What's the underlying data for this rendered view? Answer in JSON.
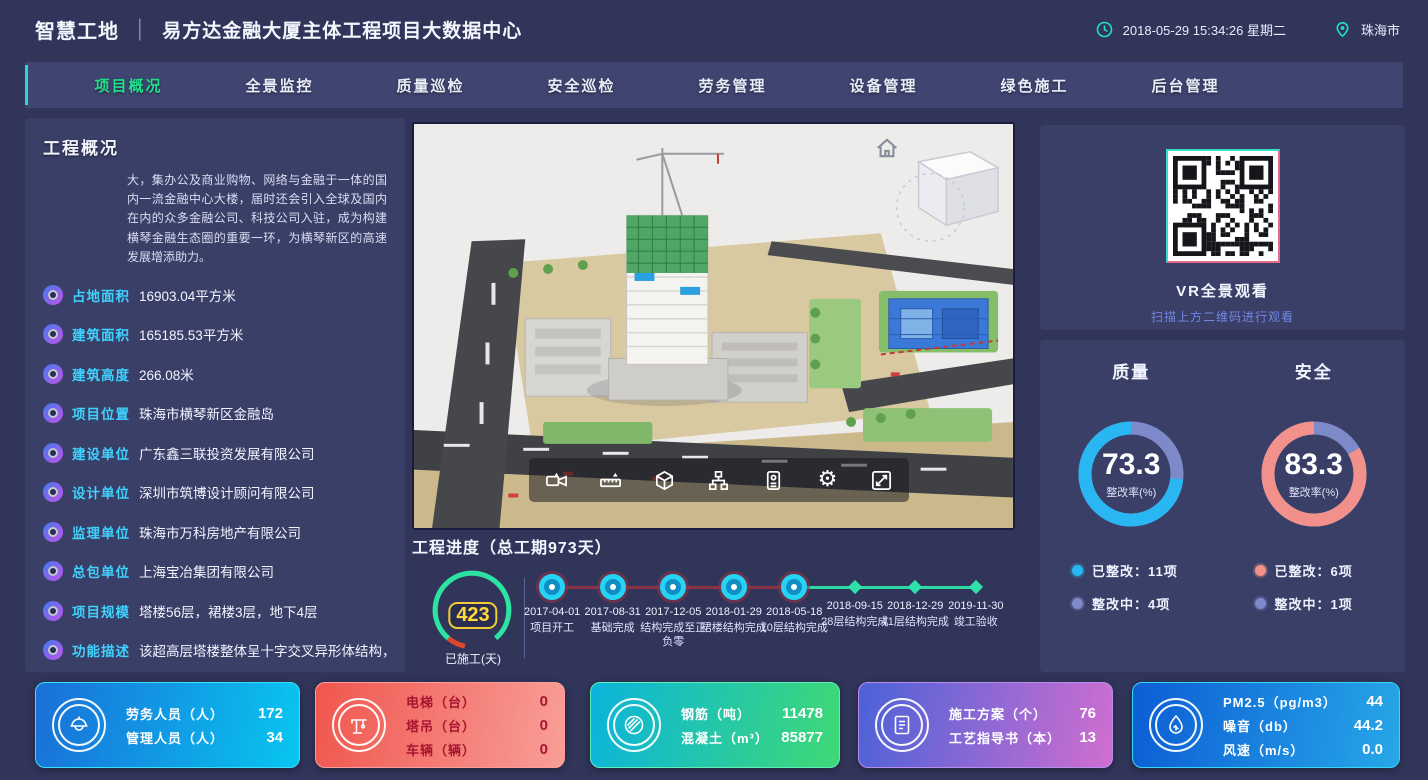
{
  "header": {
    "brand": "智慧工地",
    "divider": "│",
    "title": "易方达金融大厦主体工程项目大数据中心",
    "datetime": "2018-05-29 15:34:26 星期二",
    "city": "珠海市"
  },
  "nav": {
    "tabs": [
      {
        "label": "项目概况",
        "active": true
      },
      {
        "label": "全景监控",
        "active": false
      },
      {
        "label": "质量巡检",
        "active": false
      },
      {
        "label": "安全巡检",
        "active": false
      },
      {
        "label": "劳务管理",
        "active": false
      },
      {
        "label": "设备管理",
        "active": false
      },
      {
        "label": "绿色施工",
        "active": false
      },
      {
        "label": "后台管理",
        "active": false
      }
    ]
  },
  "overview": {
    "title": "工程概况",
    "description": "大，集办公及商业购物、网络与金融于一体的国内一流金融中心大楼，届时还会引入全球及国内在内的众多金融公司、科技公司入驻，成为构建横琴金融生态圈的重要一环，为横琴新区的高速发展增添助力。",
    "items": [
      {
        "label": "占地面积",
        "value": "16903.04平方米"
      },
      {
        "label": "建筑面积",
        "value": "165185.53平方米"
      },
      {
        "label": "建筑高度",
        "value": "266.08米"
      },
      {
        "label": "项目位置",
        "value": "珠海市横琴新区金融岛"
      },
      {
        "label": "建设单位",
        "value": "广东鑫三联投资发展有限公司"
      },
      {
        "label": "设计单位",
        "value": "深圳市筑博设计顾问有限公司"
      },
      {
        "label": "监理单位",
        "value": "珠海市万科房地产有限公司"
      },
      {
        "label": "总包单位",
        "value": "上海宝冶集团有限公司"
      },
      {
        "label": "项目规模",
        "value": "塔楼56层，裙楼3层，地下4层"
      },
      {
        "label": "功能描述",
        "value": "该超高层塔楼整体呈十字交叉异形体结构，屋面为"
      }
    ]
  },
  "viewport": {
    "toolbar_icons": [
      "video-camera",
      "measure-tool",
      "cube-3d",
      "hierarchy",
      "id-card",
      "gear",
      "fullscreen"
    ]
  },
  "progress": {
    "title": "工程进度（总工期973天）",
    "days_done": "423",
    "days_done_label": "已施工(天)",
    "milestones": [
      {
        "date": "2017-04-01",
        "label": "项目开工",
        "state": "done"
      },
      {
        "date": "2017-08-31",
        "label": "基础完成",
        "state": "done"
      },
      {
        "date": "2017-12-05",
        "label": "结构完成至正负零",
        "state": "done"
      },
      {
        "date": "2018-01-29",
        "label": "裙楼结构完成",
        "state": "done"
      },
      {
        "date": "2018-05-18",
        "label": "10层结构完成",
        "state": "done"
      },
      {
        "date": "2018-09-15",
        "label": "28层结构完成",
        "state": "pending"
      },
      {
        "date": "2018-12-29",
        "label": "41层结构完成",
        "state": "pending"
      },
      {
        "date": "2019-11-30",
        "label": "竣工验收",
        "state": "pending"
      }
    ]
  },
  "vr": {
    "title": "VR全景观看",
    "subtitle": "扫描上方二维码进行观看"
  },
  "charts": {
    "quality": {
      "title": "质量",
      "value": 73.3,
      "center_label": "整改率(%)",
      "color": "#29b7f3",
      "rest_color": "#7d89c8",
      "legend": [
        {
          "label": "已整改：11项",
          "color": "#29b7f3"
        },
        {
          "label": "整改中：4项",
          "color": "#7d89c8"
        }
      ]
    },
    "safety": {
      "title": "安全",
      "value": 83.3,
      "center_label": "整改率(%)",
      "color": "#f2918c",
      "rest_color": "#7d89c8",
      "legend": [
        {
          "label": "已整改：6项",
          "color": "#f2918c"
        },
        {
          "label": "整改中：1项",
          "color": "#7d89c8"
        }
      ]
    }
  },
  "cards": [
    {
      "icon": "worker-icon",
      "rows": [
        {
          "label": "劳务人员（人）",
          "value": "172"
        },
        {
          "label": "管理人员（人）",
          "value": "34"
        }
      ]
    },
    {
      "icon": "tower-crane-icon",
      "rows": [
        {
          "label": "电梯（台）",
          "value": "0"
        },
        {
          "label": "塔吊（台）",
          "value": "0"
        },
        {
          "label": "车辆（辆）",
          "value": "0"
        }
      ]
    },
    {
      "icon": "rebar-icon",
      "rows": [
        {
          "label": "钢筋（吨）",
          "value": "11478"
        },
        {
          "label": "混凝土（m³）",
          "value": "85877"
        }
      ]
    },
    {
      "icon": "document-icon",
      "rows": [
        {
          "label": "施工方案（个）",
          "value": "76"
        },
        {
          "label": "工艺指导书（本）",
          "value": "13"
        }
      ]
    },
    {
      "icon": "env-monitor-icon",
      "rows": [
        {
          "label": "PM2.5（pg/m3）",
          "value": "44"
        },
        {
          "label": "噪音（db）",
          "value": "44.2"
        },
        {
          "label": "风速（m/s）",
          "value": "0.0"
        }
      ]
    }
  ]
}
